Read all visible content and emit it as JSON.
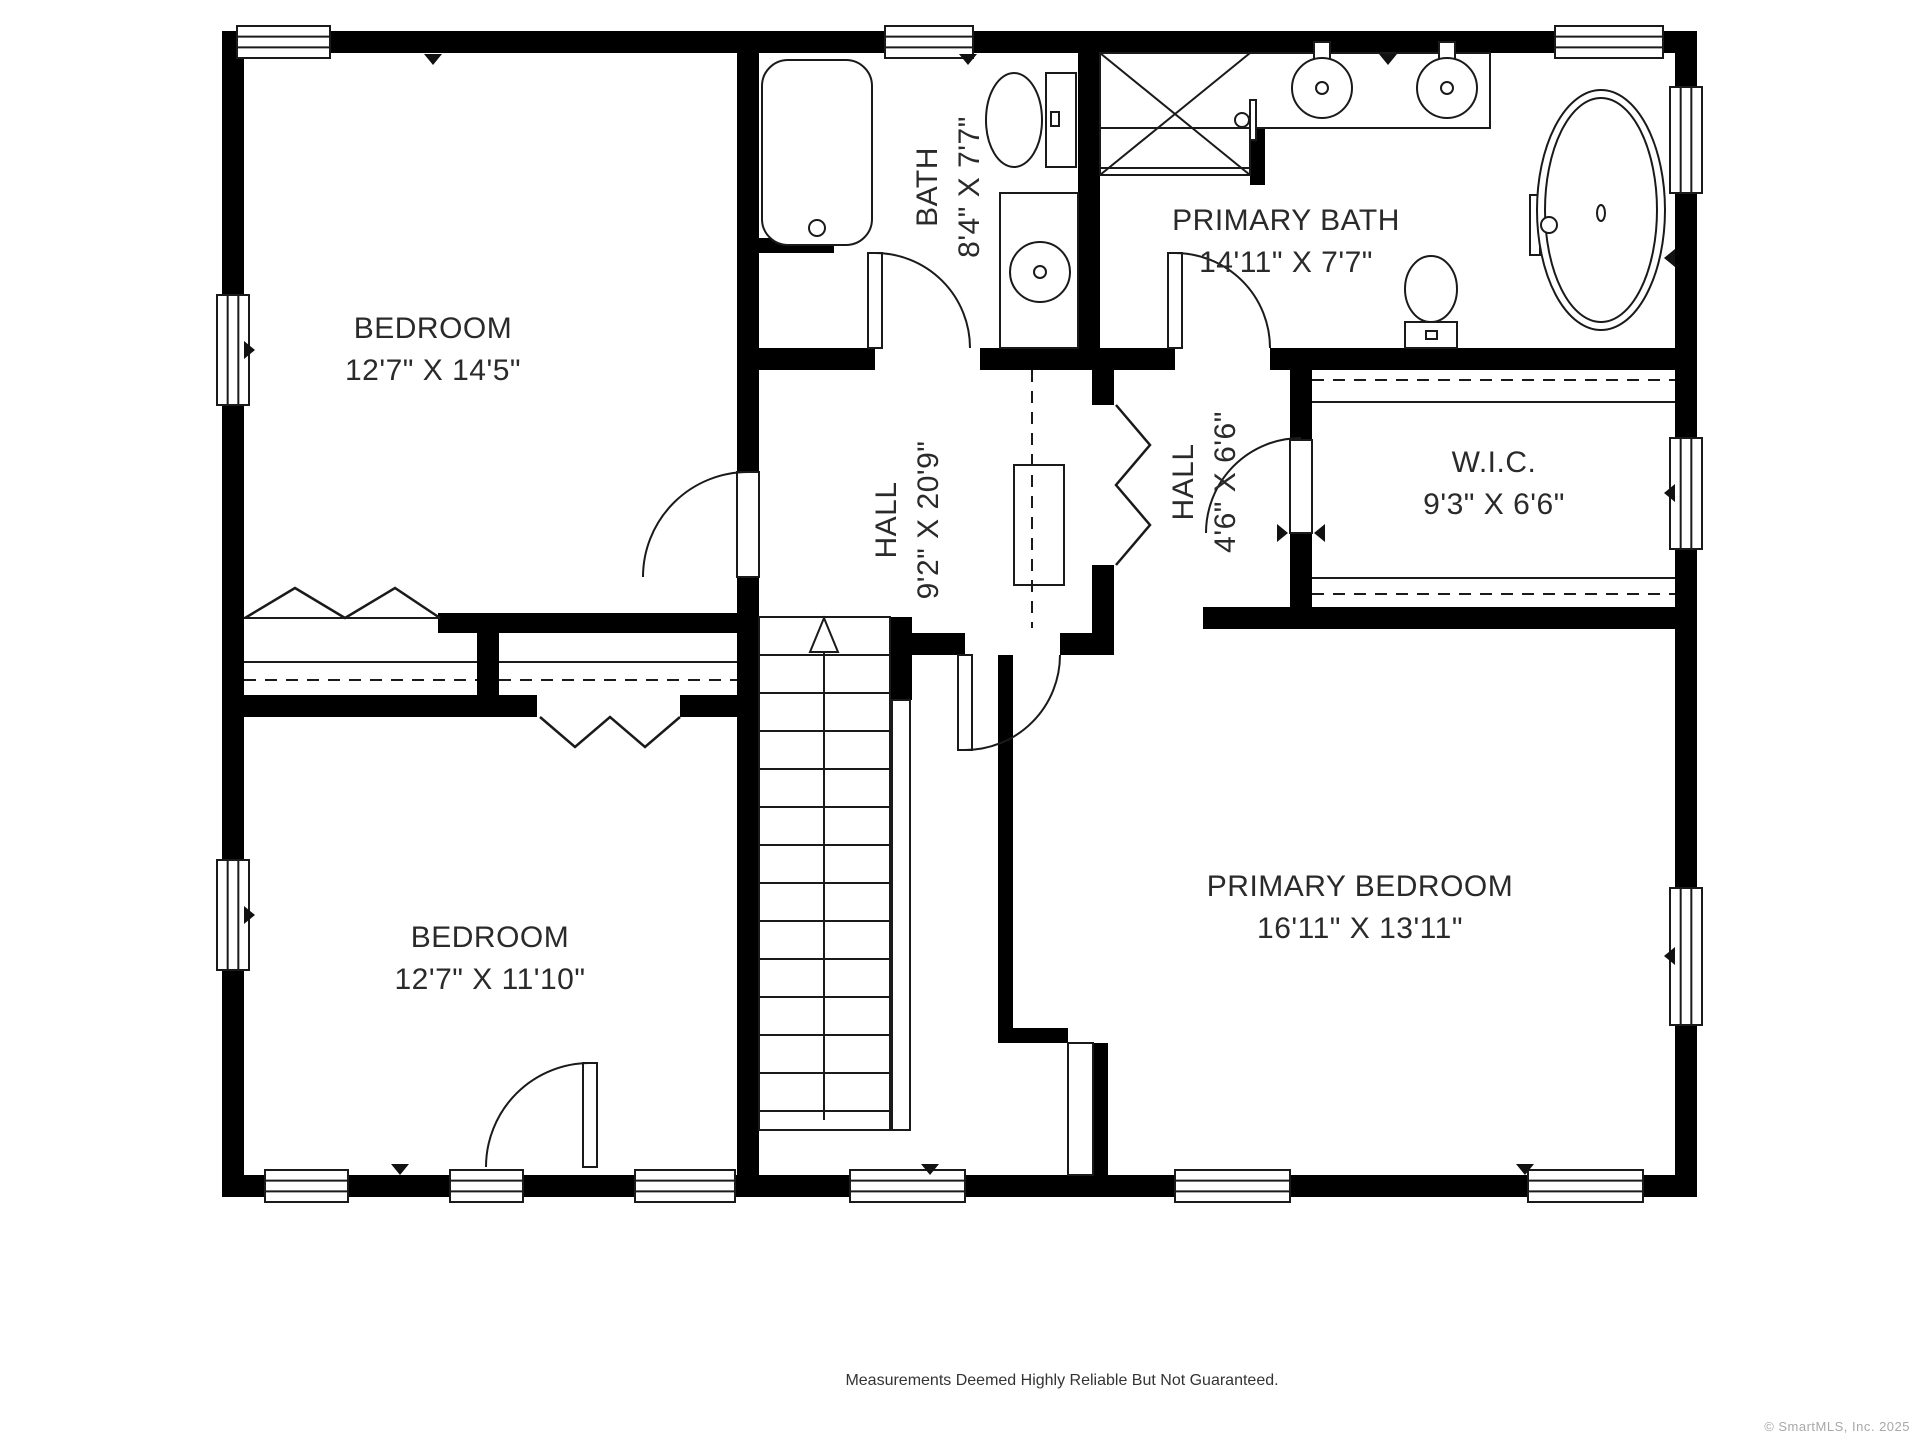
{
  "footer": {
    "disclaimer": "Measurements Deemed Highly Reliable But Not Guaranteed.",
    "copyright": "© SmartMLS, Inc. 2025"
  },
  "plan": {
    "colors": {
      "wall": "#000000",
      "line": "#1a1a1a",
      "label": "#2a2a2a",
      "window_fill": "#ffffff",
      "marker": "#111111"
    },
    "rooms": [
      {
        "name": "bedroom-1",
        "label": "BEDROOM",
        "dims": "12'7\" X 14'5\"",
        "x": 433,
        "y": 348,
        "rotate": false
      },
      {
        "name": "bath",
        "label": "BATH",
        "dims": "8'4\" X 7'7\"",
        "x": 947,
        "y": 187,
        "rotate": true
      },
      {
        "name": "primary-bath",
        "label": "PRIMARY BATH",
        "dims": "14'11\" X 7'7\"",
        "x": 1286,
        "y": 240,
        "rotate": false
      },
      {
        "name": "hall",
        "label": "HALL",
        "dims": "9'2\" X 20'9\"",
        "x": 906,
        "y": 520,
        "rotate": true
      },
      {
        "name": "hall-2",
        "label": "HALL",
        "dims": "4'6\" X 6'6\"",
        "x": 1203,
        "y": 482,
        "rotate": true
      },
      {
        "name": "wic",
        "label": "W.I.C.",
        "dims": "9'3\" X 6'6\"",
        "x": 1494,
        "y": 482,
        "rotate": false
      },
      {
        "name": "bedroom-2",
        "label": "BEDROOM",
        "dims": "12'7\" X 11'10\"",
        "x": 490,
        "y": 957,
        "rotate": false
      },
      {
        "name": "primary-bedroom",
        "label": "PRIMARY BEDROOM",
        "dims": "16'11\" X 13'11\"",
        "x": 1360,
        "y": 906,
        "rotate": false
      }
    ],
    "walls": [
      [
        222,
        31,
        1475,
        22
      ],
      [
        222,
        1175,
        1475,
        22
      ],
      [
        222,
        31,
        22,
        1166
      ],
      [
        1675,
        31,
        22,
        1166
      ],
      [
        737,
        53,
        22,
        419
      ],
      [
        737,
        577,
        22,
        598
      ],
      [
        1078,
        53,
        22,
        317
      ],
      [
        759,
        348,
        116,
        22
      ],
      [
        980,
        348,
        195,
        22
      ],
      [
        1270,
        348,
        405,
        22
      ],
      [
        438,
        613,
        299,
        20
      ],
      [
        477,
        613,
        22,
        104
      ],
      [
        222,
        695,
        315,
        22
      ],
      [
        680,
        695,
        79,
        22
      ],
      [
        890,
        617,
        22,
        83
      ],
      [
        912,
        633,
        53,
        22
      ],
      [
        1060,
        633,
        54,
        22
      ],
      [
        1092,
        370,
        22,
        35
      ],
      [
        1092,
        565,
        22,
        68
      ],
      [
        1290,
        370,
        22,
        70
      ],
      [
        1290,
        533,
        22,
        96
      ],
      [
        1203,
        607,
        472,
        22
      ],
      [
        998,
        655,
        15,
        373
      ],
      [
        998,
        1028,
        70,
        15
      ],
      [
        1093,
        1043,
        15,
        132
      ],
      [
        1250,
        53,
        15,
        132
      ],
      [
        759,
        238,
        75,
        15
      ]
    ],
    "windows": [
      [
        237,
        26,
        93,
        32
      ],
      [
        885,
        26,
        88,
        32
      ],
      [
        1555,
        26,
        108,
        32
      ],
      [
        217,
        295,
        32,
        110
      ],
      [
        217,
        860,
        32,
        110
      ],
      [
        1670,
        87,
        32,
        106
      ],
      [
        1670,
        438,
        32,
        111
      ],
      [
        1670,
        888,
        32,
        137
      ],
      [
        265,
        1170,
        83,
        32
      ],
      [
        450,
        1170,
        73,
        32
      ],
      [
        635,
        1170,
        100,
        32
      ],
      [
        850,
        1170,
        115,
        32
      ],
      [
        1175,
        1170,
        115,
        32
      ],
      [
        1528,
        1170,
        115,
        32
      ]
    ],
    "door_leaves": [
      [
        737,
        472,
        22,
        105
      ],
      [
        868,
        253,
        14,
        95
      ],
      [
        1168,
        253,
        14,
        95
      ],
      [
        958,
        655,
        14,
        95
      ],
      [
        1290,
        440,
        22,
        93
      ],
      [
        583,
        1063,
        14,
        104
      ]
    ],
    "door_arcs": [
      "M748,472 A105,105 0 0 0 643,577",
      "M590,1063 A104,104 0 0 0 486,1167",
      "M875,253 A95,95 0 0 1 970,348",
      "M1175,253 A95,95 0 0 1 1270,348",
      "M965,750 A95,95 0 0 0 1060,655",
      "M1301,438 A95,95 0 0 0 1206,533"
    ],
    "bifolds": [
      "M245,618 L295,588 L345,618 L395,588 L440,618",
      "M540,717 L575,747 L610,717 L645,747 L680,717",
      "M1116,405 L1150,445 L1116,485 L1150,525 L1116,565"
    ],
    "lines": [
      [
        244,
        618,
        440,
        618,
        0,
        "closet-track"
      ],
      [
        244,
        662,
        477,
        662,
        0,
        "closet-shelf-line"
      ],
      [
        244,
        680,
        477,
        680,
        1,
        "closet-rod"
      ],
      [
        499,
        662,
        737,
        662,
        0,
        "closet-shelf-line"
      ],
      [
        499,
        680,
        737,
        680,
        1,
        "closet-rod"
      ],
      [
        1312,
        380,
        1675,
        380,
        1,
        "closet-rod"
      ],
      [
        1312,
        402,
        1675,
        402,
        0,
        "closet-shelf-line"
      ],
      [
        1312,
        578,
        1675,
        578,
        0,
        "closet-shelf-line"
      ],
      [
        1312,
        594,
        1675,
        594,
        1,
        "closet-rod"
      ],
      [
        1032,
        370,
        1032,
        628,
        1,
        "closet-rod"
      ],
      [
        1100,
        53,
        1250,
        175,
        0,
        "shower-x"
      ],
      [
        1250,
        53,
        1100,
        175,
        0,
        "shower-x"
      ],
      [
        1100,
        168,
        1250,
        168,
        0,
        "shower-edge"
      ]
    ],
    "fixture_rects": [
      [
        1100,
        53,
        150,
        122,
        "shower"
      ],
      [
        1000,
        193,
        78,
        155,
        "vanity"
      ],
      [
        1100,
        53,
        390,
        75,
        "vanity"
      ],
      [
        1046,
        73,
        30,
        94,
        "toilet-tank"
      ],
      [
        1051,
        112,
        8,
        14,
        "toilet-flush"
      ],
      [
        1405,
        322,
        52,
        26,
        "toilet-tank"
      ],
      [
        1426,
        331,
        11,
        8,
        "toilet-flush"
      ],
      [
        1314,
        42,
        16,
        34,
        "faucet"
      ],
      [
        1439,
        42,
        16,
        34,
        "faucet"
      ],
      [
        792,
        236,
        50,
        9,
        "tub-faucet"
      ],
      [
        813,
        212,
        8,
        14,
        "tub-faucet"
      ],
      [
        1530,
        195,
        10,
        60,
        "tub-faucet"
      ],
      [
        1250,
        100,
        6,
        40,
        "shower-head"
      ],
      [
        1068,
        1043,
        25,
        132,
        "chimney-flue"
      ],
      [
        1014,
        465,
        50,
        120,
        "closet-shelf"
      ],
      [
        892,
        700,
        18,
        430,
        "stair-railing"
      ]
    ],
    "rounded_rects": [
      [
        762,
        60,
        110,
        185,
        26,
        "bathtub"
      ]
    ],
    "ellipses": [
      [
        1014,
        120,
        28,
        47,
        "toilet-bowl"
      ],
      [
        1431,
        289,
        26,
        33,
        "toilet-bowl"
      ],
      [
        1601,
        210,
        64,
        120,
        "soaking-tub"
      ],
      [
        1601,
        210,
        56,
        112,
        "soaking-tub-inner"
      ],
      [
        1601,
        213,
        4,
        8,
        "tub-drain"
      ]
    ],
    "circles": [
      [
        1040,
        272,
        30,
        "sink"
      ],
      [
        1040,
        272,
        6,
        "sink-drain"
      ],
      [
        1322,
        88,
        30,
        "sink"
      ],
      [
        1322,
        88,
        6,
        "sink-drain"
      ],
      [
        1447,
        88,
        30,
        "sink"
      ],
      [
        1447,
        88,
        6,
        "sink-drain"
      ],
      [
        817,
        228,
        8,
        "tub-faucet-knob"
      ],
      [
        1549,
        225,
        8,
        "tub-faucet-knob"
      ],
      [
        1242,
        120,
        7,
        "shower-knob"
      ]
    ],
    "stairs": {
      "outline": [
        759,
        617,
        131,
        513
      ],
      "tread_x": [
        759,
        890
      ],
      "treads_y": [
        655,
        693,
        731,
        769,
        807,
        845,
        883,
        921,
        959,
        997,
        1035,
        1073,
        1111
      ],
      "arrow_line": [
        824,
        650,
        824,
        1120
      ],
      "arrow_head": "824,618 810,652 838,652"
    },
    "triangles": [
      [
        433,
        54,
        "down"
      ],
      [
        968,
        54,
        "down"
      ],
      [
        1388,
        54,
        "down"
      ],
      [
        400,
        1164,
        "down"
      ],
      [
        930,
        1164,
        "down"
      ],
      [
        1525,
        1164,
        "down"
      ],
      [
        244,
        350,
        "right"
      ],
      [
        244,
        915,
        "right"
      ],
      [
        1277,
        533,
        "right"
      ],
      [
        1675,
        258,
        "left"
      ],
      [
        1675,
        493,
        "left"
      ],
      [
        1675,
        956,
        "left"
      ],
      [
        1325,
        533,
        "left"
      ]
    ]
  }
}
